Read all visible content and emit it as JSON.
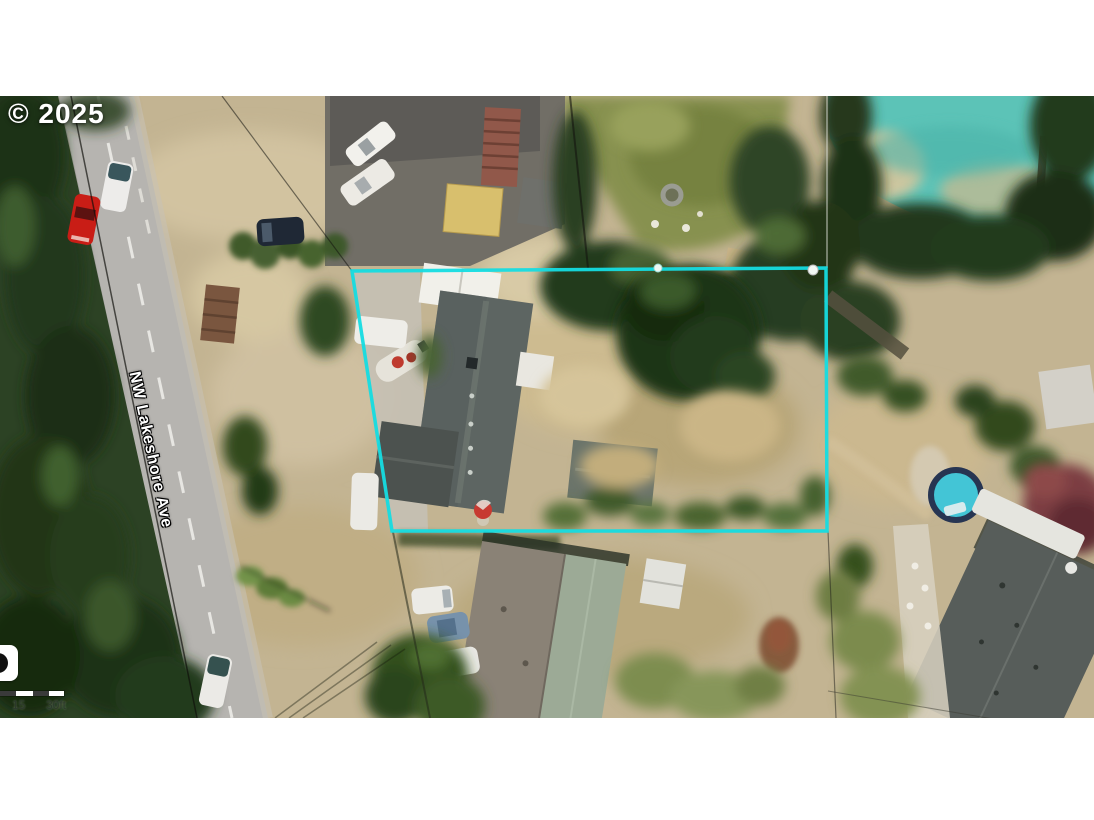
{
  "window": {
    "width": 1094,
    "height": 820,
    "letterbox_color": "#ffffff"
  },
  "map": {
    "kind": "satellite-aerial-photo",
    "copyright": "© 2025",
    "road_label": "NW Lakeshore Ave",
    "scale_bar": {
      "mid_label": "15",
      "end_label": "30ft"
    },
    "logo": "map-provider-logo cropped at left edge",
    "boundary_markers": 2,
    "colors": {
      "parcel_boundary": "#15dce2",
      "water": "#5cc3b7",
      "road": "#b6b4b0",
      "ground": "#c3b492",
      "forest": "#2c4224",
      "lawn": "#87914f",
      "main_roof": "#5d6562",
      "sage_roof": "#9caa96",
      "pool_water": "#43c5d6",
      "red_car": "#c91d16"
    }
  }
}
